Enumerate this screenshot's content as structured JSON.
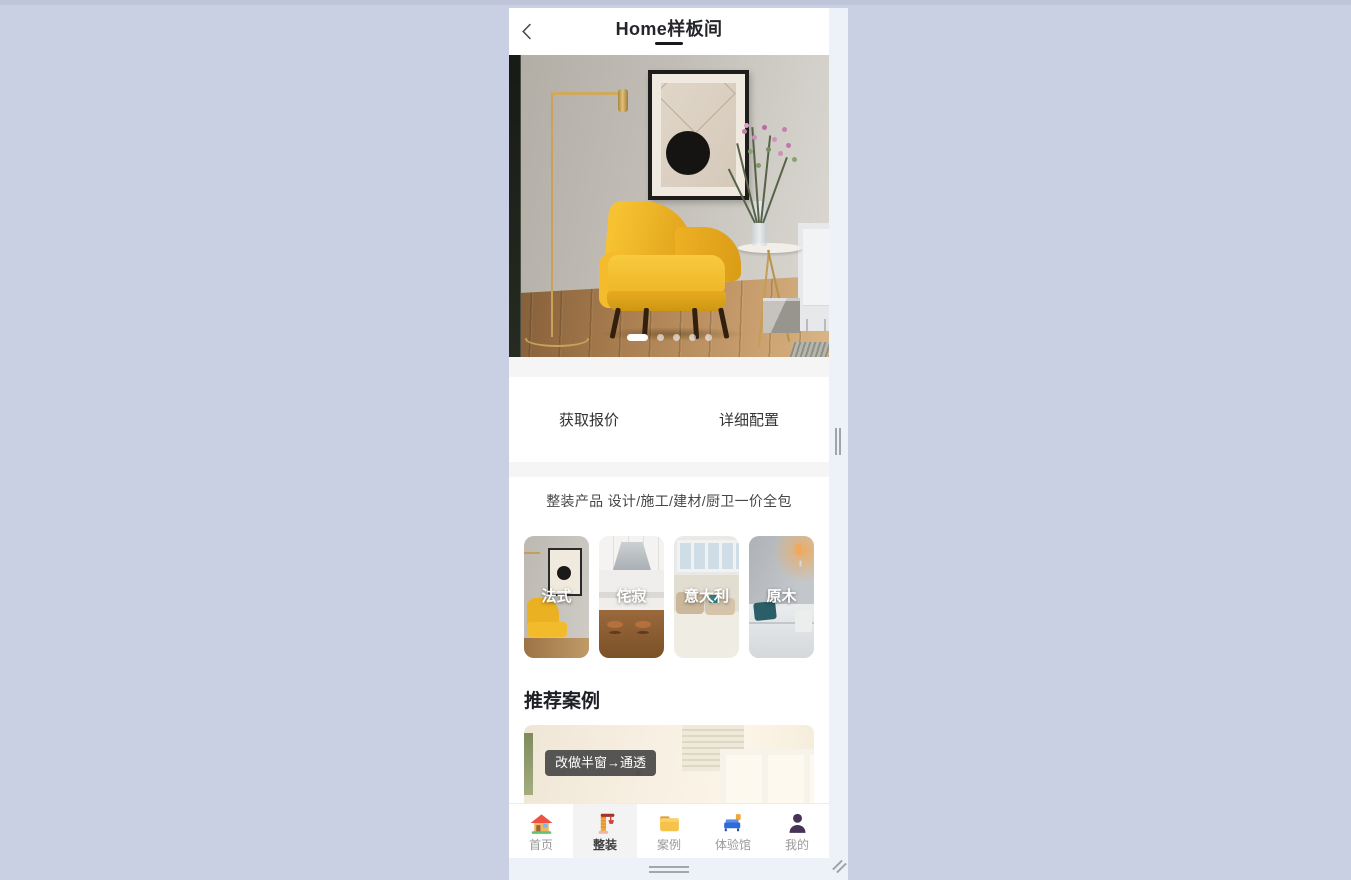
{
  "header": {
    "title": "Home样板间",
    "back_icon": "chevron-left-icon"
  },
  "carousel": {
    "slide_count": 5,
    "active_slide": 1
  },
  "cta": {
    "quote_label": "获取报价",
    "config_label": "详细配置"
  },
  "promo": {
    "text": "整装产品 设计/施工/建材/厨卫一价全包"
  },
  "styles": {
    "items": [
      {
        "label": "法式"
      },
      {
        "label": "侘寂"
      },
      {
        "label": "意大利"
      },
      {
        "label": "原木"
      }
    ]
  },
  "recommended": {
    "title": "推荐案例",
    "case_tag": "改做半窗→通透"
  },
  "tabbar": {
    "items": [
      {
        "label": "首页",
        "icon": "home-icon",
        "active": false
      },
      {
        "label": "整装",
        "icon": "crane-icon",
        "active": true
      },
      {
        "label": "案例",
        "icon": "folder-icon",
        "active": false
      },
      {
        "label": "体验馆",
        "icon": "sofa-icon",
        "active": false
      },
      {
        "label": "我的",
        "icon": "user-icon",
        "active": false
      }
    ]
  },
  "colors": {
    "canvas": "#c9d0e3",
    "gutter": "#edf1f8",
    "panel": "#ffffff",
    "divider": "#f5f5f6",
    "accent_yellow": "#f2b82d",
    "tab_label": "#9a9a9a",
    "tab_label_active": "#3f3f3f",
    "tag_bg": "#484848"
  }
}
